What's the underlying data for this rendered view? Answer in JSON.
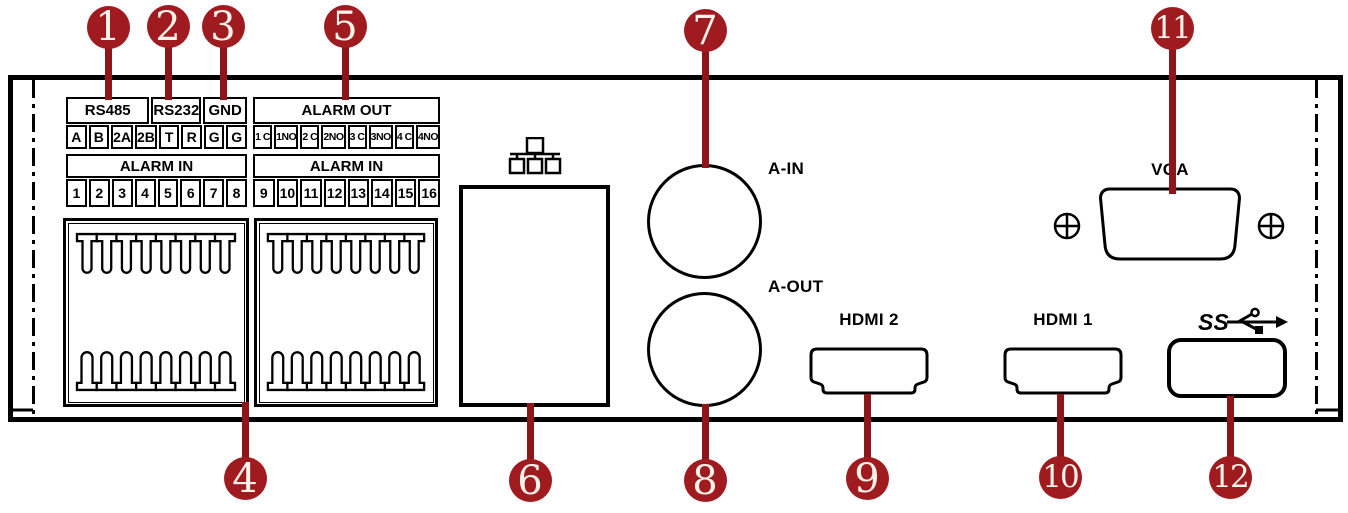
{
  "colors": {
    "callout_fill": "#A01B20",
    "callout_stem": "#8E151A",
    "outline": "#000000",
    "background": "#FFFFFF"
  },
  "callouts": [
    "1",
    "2",
    "3",
    "4",
    "5",
    "6",
    "7",
    "8",
    "9",
    "10",
    "11",
    "12"
  ],
  "tables": {
    "serial": {
      "headers": [
        {
          "label": "RS485",
          "span": 4
        },
        {
          "label": "RS232",
          "span": 2
        },
        {
          "label": "GND",
          "span": 2
        }
      ],
      "cells": [
        "A",
        "B",
        "2A",
        "2B",
        "T",
        "R",
        "G",
        "G"
      ]
    },
    "alarm_out": {
      "headers": [
        {
          "label": "ALARM OUT",
          "span": 8
        }
      ],
      "cells": [
        "1 C",
        "1NO",
        "2 C",
        "2NO",
        "3 C",
        "3NO",
        "4 C",
        "4NO"
      ]
    },
    "alarm_in_1": {
      "headers": [
        {
          "label": "ALARM IN",
          "span": 8
        }
      ],
      "cells": [
        "1",
        "2",
        "3",
        "4",
        "5",
        "6",
        "7",
        "8"
      ]
    },
    "alarm_in_2": {
      "headers": [
        {
          "label": "ALARM IN",
          "span": 8
        }
      ],
      "cells": [
        "9",
        "10",
        "11",
        "12",
        "13",
        "14",
        "15",
        "16"
      ]
    }
  },
  "terminal_blocks": {
    "count": 2,
    "top_pins_per_block": 8,
    "bottom_pins_per_block": 8
  },
  "ports": {
    "audio_in_label": "A-IN",
    "audio_out_label": "A-OUT",
    "hdmi_2_label": "HDMI 2",
    "hdmi_1_label": "HDMI 1",
    "vga_label": "VGA",
    "usb_superspeed_label": "SS"
  },
  "icons": {
    "network": "lan-network-icon",
    "usb": "usb3-superspeed-trident-icon",
    "screws": "screw-crosshead-icon"
  }
}
